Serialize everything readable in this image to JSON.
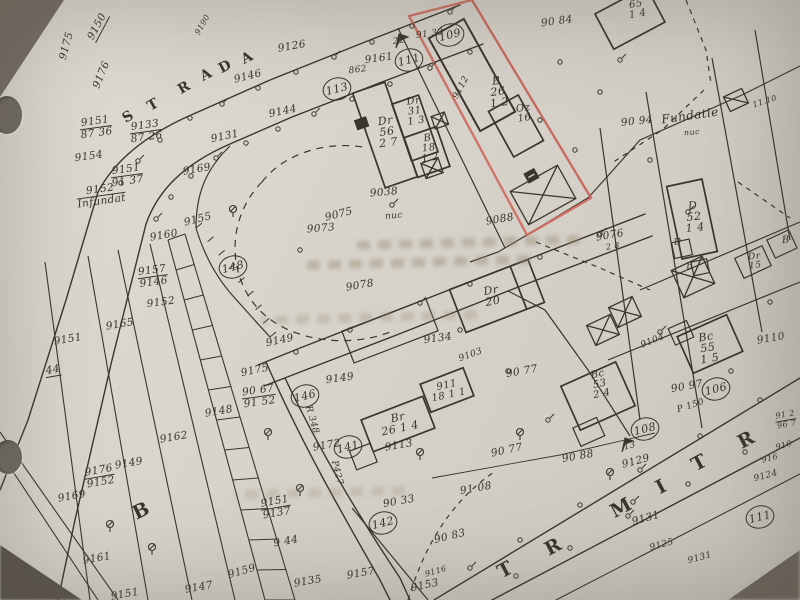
{
  "photo": {
    "paper_color": "#d9d5cd",
    "ink_color": "#38332b",
    "highlight_color": "#cf6a60",
    "description": "Scanned cadastral plan sheet with red-outlined parcel"
  },
  "streets": {
    "strada": {
      "name": "STRADA",
      "fs": 14,
      "letters": [
        {
          "ch": "S",
          "x": 128,
          "y": 117,
          "r": -32
        },
        {
          "ch": "T",
          "x": 153,
          "y": 105,
          "r": -30
        },
        {
          "ch": "R",
          "x": 184,
          "y": 88,
          "r": -30
        },
        {
          "ch": "A",
          "x": 206,
          "y": 75,
          "r": -28
        },
        {
          "ch": "D",
          "x": 225,
          "y": 67,
          "r": -28
        },
        {
          "ch": "A",
          "x": 247,
          "y": 58,
          "r": -28
        }
      ]
    },
    "mitr": {
      "name": "MITR",
      "fs": 19,
      "letters": [
        {
          "ch": "T",
          "x": 505,
          "y": 570,
          "r": -28
        },
        {
          "ch": "R",
          "x": 553,
          "y": 547,
          "r": -28
        },
        {
          "ch": "M",
          "x": 621,
          "y": 508,
          "r": -28
        },
        {
          "ch": "I",
          "x": 661,
          "y": 487,
          "r": -28
        },
        {
          "ch": "T",
          "x": 699,
          "y": 463,
          "r": -28
        },
        {
          "ch": "R",
          "x": 746,
          "y": 440,
          "r": -28
        }
      ]
    },
    "b": {
      "name": "B",
      "fs": 19,
      "letters": [
        {
          "ch": "B",
          "x": 141,
          "y": 511,
          "r": -26
        }
      ]
    }
  },
  "circled_points": [
    {
      "n": "113",
      "x": 337,
      "y": 89
    },
    {
      "n": "111",
      "x": 409,
      "y": 60
    },
    {
      "n": "109",
      "x": 450,
      "y": 35
    },
    {
      "n": "148",
      "x": 233,
      "y": 267
    },
    {
      "n": "146",
      "x": 305,
      "y": 396
    },
    {
      "n": "141",
      "x": 348,
      "y": 447
    },
    {
      "n": "142",
      "x": 383,
      "y": 523
    },
    {
      "n": "108",
      "x": 645,
      "y": 429
    },
    {
      "n": "106",
      "x": 716,
      "y": 389
    },
    {
      "n": "111",
      "x": 760,
      "y": 517
    }
  ],
  "labels": [
    {
      "t": "9150",
      "x": 98,
      "y": 27,
      "r": -62,
      "u": 1
    },
    {
      "t": "9175",
      "x": 67,
      "y": 46,
      "r": -75
    },
    {
      "t": "9176",
      "x": 102,
      "y": 75,
      "r": -68
    },
    {
      "t": "9190",
      "x": 203,
      "y": 25,
      "r": -60,
      "fs": 8
    },
    {
      "t": "9126",
      "x": 292,
      "y": 47,
      "r": -10
    },
    {
      "t": "9146",
      "x": 248,
      "y": 77,
      "r": -14
    },
    {
      "t": "9144",
      "x": 283,
      "y": 112,
      "r": -12
    },
    {
      "t": "9131",
      "x": 225,
      "y": 137,
      "r": -12
    },
    {
      "t": "9151",
      "t2": "87 36",
      "x": 96,
      "y": 128,
      "r": -8,
      "u": 1
    },
    {
      "t": "9133",
      "t2": "87 26",
      "x": 146,
      "y": 132,
      "r": -8,
      "u": 1
    },
    {
      "t": "9154",
      "x": 89,
      "y": 157,
      "r": -8
    },
    {
      "t": "9151",
      "t2": "91 37",
      "x": 127,
      "y": 176,
      "r": -8,
      "u": 1
    },
    {
      "t": "9152",
      "t2": "Infundat",
      "x": 101,
      "y": 196,
      "r": -8,
      "u": 1
    },
    {
      "t": "9169",
      "x": 197,
      "y": 170,
      "r": -10
    },
    {
      "t": "9155",
      "x": 198,
      "y": 220,
      "r": -14
    },
    {
      "t": "9160",
      "x": 164,
      "y": 236,
      "r": -10
    },
    {
      "t": "9157",
      "t2": "9146",
      "x": 153,
      "y": 277,
      "r": -8,
      "u": 1
    },
    {
      "t": "9152",
      "x": 161,
      "y": 303,
      "r": -8
    },
    {
      "t": "9165",
      "x": 120,
      "y": 325,
      "r": -10
    },
    {
      "t": "9151",
      "x": 68,
      "y": 340,
      "r": -10
    },
    {
      "t": "44",
      "x": 53,
      "y": 371,
      "r": -10,
      "u": 1
    },
    {
      "t": "9148",
      "x": 219,
      "y": 412,
      "r": -10
    },
    {
      "t": "9162",
      "x": 174,
      "y": 438,
      "r": -10
    },
    {
      "t": "9149",
      "x": 129,
      "y": 464,
      "r": -10
    },
    {
      "t": "9176",
      "t2": "9152",
      "x": 100,
      "y": 477,
      "r": -10,
      "u": 1
    },
    {
      "t": "9169",
      "x": 72,
      "y": 497,
      "r": -10
    },
    {
      "t": "9161",
      "x": 97,
      "y": 559,
      "r": -10
    },
    {
      "t": "9151",
      "x": 125,
      "y": 595,
      "r": -10
    },
    {
      "t": "9147",
      "x": 199,
      "y": 588,
      "r": -10
    },
    {
      "t": "9159",
      "x": 242,
      "y": 572,
      "r": -16
    },
    {
      "t": "9135",
      "x": 308,
      "y": 582,
      "r": -10
    },
    {
      "t": "9157",
      "x": 361,
      "y": 574,
      "r": -10
    },
    {
      "t": "9 44",
      "x": 286,
      "y": 542,
      "r": -10
    },
    {
      "t": "9151",
      "t2": "9137",
      "x": 276,
      "y": 508,
      "r": -10,
      "u": 1
    },
    {
      "t": "9038",
      "x": 384,
      "y": 193,
      "r": -5
    },
    {
      "t": "9075",
      "x": 339,
      "y": 215,
      "r": -14
    },
    {
      "t": "9073",
      "x": 321,
      "y": 229,
      "r": -5
    },
    {
      "t": "nuc",
      "x": 394,
      "y": 217,
      "r": -5,
      "fs": 9
    },
    {
      "t": "9078",
      "x": 360,
      "y": 286,
      "r": -10
    },
    {
      "t": "9088",
      "x": 500,
      "y": 220,
      "r": -10
    },
    {
      "t": "9076",
      "x": 610,
      "y": 236,
      "r": -10
    },
    {
      "t": "2 8",
      "x": 613,
      "y": 247,
      "r": -10,
      "fs": 8
    },
    {
      "t": "90 94",
      "x": 637,
      "y": 122,
      "r": -6
    },
    {
      "t": "Fundatie",
      "x": 690,
      "y": 116,
      "r": -8,
      "fs": 12
    },
    {
      "t": "nuc",
      "x": 692,
      "y": 133,
      "r": -5,
      "fs": 8
    },
    {
      "t": "11.10",
      "x": 765,
      "y": 102,
      "r": -18,
      "fs": 8
    },
    {
      "t": "90 84",
      "x": 557,
      "y": 22,
      "r": -8
    },
    {
      "t": "22",
      "x": 399,
      "y": 42,
      "r": -8,
      "fs": 9
    },
    {
      "t": "91 33",
      "x": 430,
      "y": 35,
      "r": -8,
      "fs": 9
    },
    {
      "t": "9161",
      "x": 379,
      "y": 59,
      "r": -8
    },
    {
      "t": "862",
      "x": 358,
      "y": 71,
      "r": -8,
      "fs": 9
    },
    {
      "t": "9112",
      "x": 462,
      "y": 88,
      "r": -62,
      "fs": 9
    },
    {
      "t": "9134",
      "x": 438,
      "y": 339,
      "r": -8
    },
    {
      "t": "9103",
      "x": 471,
      "y": 356,
      "r": -20,
      "fs": 9
    },
    {
      "t": "90 77",
      "x": 522,
      "y": 372,
      "r": -10
    },
    {
      "t": "90 77",
      "x": 507,
      "y": 451,
      "r": -12
    },
    {
      "t": "90 88",
      "x": 578,
      "y": 457,
      "r": -10
    },
    {
      "t": "91 08",
      "x": 476,
      "y": 489,
      "r": -10
    },
    {
      "t": "90 33",
      "x": 399,
      "y": 502,
      "r": -10
    },
    {
      "t": "90 83",
      "x": 450,
      "y": 537,
      "r": -14
    },
    {
      "t": "9153",
      "x": 425,
      "y": 586,
      "r": -12
    },
    {
      "t": "9116",
      "x": 436,
      "y": 572,
      "r": -16,
      "fs": 8
    },
    {
      "t": "9113",
      "x": 399,
      "y": 446,
      "r": -10
    },
    {
      "t": "9172",
      "x": 327,
      "y": 446,
      "r": -10
    },
    {
      "t": "R 348",
      "x": 311,
      "y": 420,
      "r": 74,
      "fs": 9
    },
    {
      "t": "P427",
      "x": 336,
      "y": 473,
      "r": 76,
      "fs": 9
    },
    {
      "t": "90 67",
      "t2": "91 52",
      "x": 259,
      "y": 397,
      "r": -8,
      "u": 1
    },
    {
      "t": "9175",
      "x": 255,
      "y": 371,
      "r": -12
    },
    {
      "t": "9149",
      "x": 280,
      "y": 341,
      "r": -12
    },
    {
      "t": "9149",
      "x": 340,
      "y": 379,
      "r": -8
    },
    {
      "t": "9129",
      "x": 636,
      "y": 462,
      "r": -15
    },
    {
      "t": "9124",
      "x": 766,
      "y": 477,
      "r": -15,
      "fs": 9
    },
    {
      "t": "9131",
      "x": 646,
      "y": 519,
      "r": -15
    },
    {
      "t": "9125",
      "x": 662,
      "y": 546,
      "r": -15,
      "fs": 9
    },
    {
      "t": "9131",
      "x": 700,
      "y": 559,
      "r": -15,
      "fs": 9
    },
    {
      "t": "916",
      "x": 770,
      "y": 459,
      "r": -15,
      "fs": 8
    },
    {
      "t": "910",
      "x": 784,
      "y": 446,
      "r": -15,
      "fs": 8
    },
    {
      "t": "91 2",
      "t2": "96 7",
      "x": 786,
      "y": 420,
      "r": -10,
      "u": 1,
      "fs": 8
    },
    {
      "t": "9110",
      "x": 771,
      "y": 339,
      "r": -10
    },
    {
      "t": "90 97",
      "x": 687,
      "y": 387,
      "r": -10
    },
    {
      "t": "P 150",
      "x": 691,
      "y": 407,
      "r": -18,
      "fs": 9
    },
    {
      "t": "9104",
      "x": 653,
      "y": 342,
      "r": -22,
      "fs": 9
    },
    {
      "t": "13",
      "x": 630,
      "y": 447,
      "r": -15,
      "fs": 9
    }
  ],
  "building_labels": [
    {
      "lines": [
        "Dr",
        "56",
        "2 7"
      ],
      "x": 387,
      "y": 132,
      "r": -8,
      "fs": 11
    },
    {
      "lines": [
        "Dr",
        "31",
        "1 3"
      ],
      "x": 415,
      "y": 112,
      "r": -8,
      "fs": 10
    },
    {
      "lines": [
        "B",
        "18",
        "1 2"
      ],
      "x": 429,
      "y": 149,
      "r": -8,
      "fs": 10
    },
    {
      "lines": [
        "B",
        "26",
        "1 2"
      ],
      "x": 498,
      "y": 92,
      "r": -8,
      "fs": 11
    },
    {
      "lines": [
        "Oz",
        "16"
      ],
      "x": 524,
      "y": 114,
      "r": -8,
      "fs": 10
    },
    {
      "lines": [
        "Dr",
        "20"
      ],
      "x": 492,
      "y": 296,
      "r": -10,
      "fs": 11
    },
    {
      "lines": [
        "911",
        "18 1 1"
      ],
      "x": 448,
      "y": 391,
      "r": -12,
      "fs": 10
    },
    {
      "lines": [
        "Br",
        "26 1 4"
      ],
      "x": 399,
      "y": 423,
      "r": -12,
      "fs": 11
    },
    {
      "lines": [
        "D",
        "52",
        "1 4"
      ],
      "x": 694,
      "y": 217,
      "r": -6,
      "fs": 11
    },
    {
      "lines": [
        "Dr",
        "15"
      ],
      "x": 755,
      "y": 262,
      "r": -6,
      "fs": 9
    },
    {
      "lines": [
        "B"
      ],
      "x": 786,
      "y": 241,
      "r": -6,
      "fs": 10
    },
    {
      "lines": [
        "D"
      ],
      "x": 678,
      "y": 243,
      "r": -6,
      "fs": 9
    },
    {
      "lines": [
        "B"
      ],
      "x": 690,
      "y": 267,
      "r": -6,
      "fs": 9
    },
    {
      "lines": [
        "Bc",
        "55",
        "1 5"
      ],
      "x": 708,
      "y": 348,
      "r": -10,
      "fs": 11
    },
    {
      "lines": [
        "Bc",
        "53",
        "2 4"
      ],
      "x": 600,
      "y": 385,
      "r": -12,
      "fs": 10
    },
    {
      "lines": [
        "65",
        "1 4"
      ],
      "x": 637,
      "y": 10,
      "r": -10,
      "fs": 10
    }
  ]
}
